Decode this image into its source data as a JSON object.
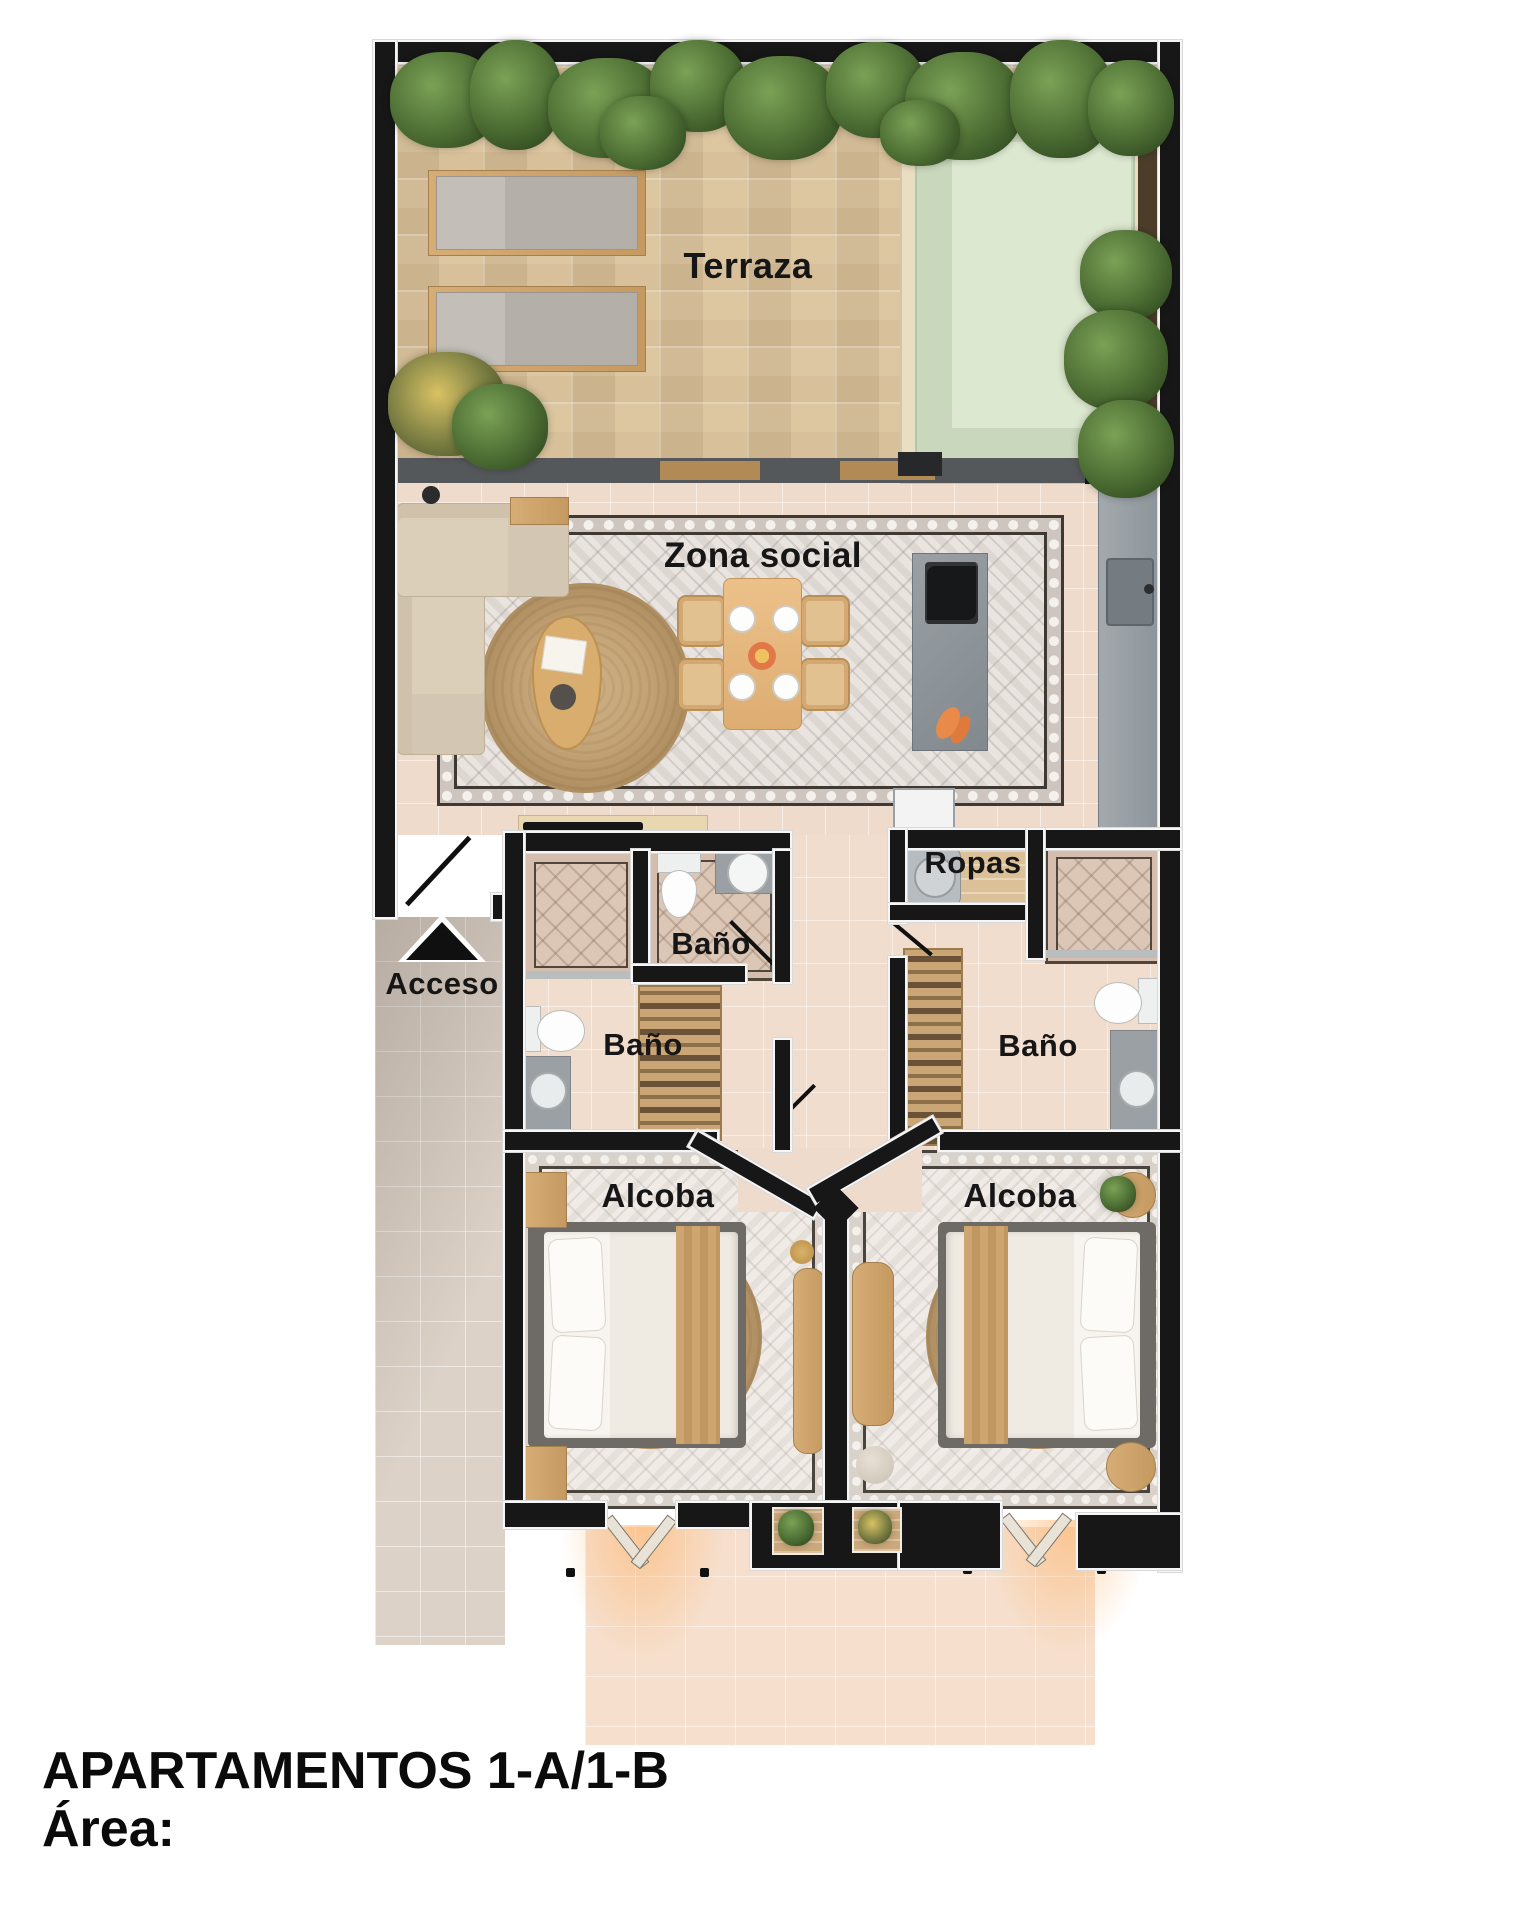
{
  "title": {
    "line1": "APARTAMENTOS 1-A/1-B",
    "line2": "Área:"
  },
  "rooms": {
    "terraza": "Terraza",
    "zona_social": "Zona social",
    "acceso": "Acceso",
    "bano_social": "Baño",
    "bano_1": "Baño",
    "bano_2": "Baño",
    "ropas": "Ropas",
    "alcoba_1": "Alcoba",
    "alcoba_2": "Alcoba"
  },
  "colors": {
    "wall": "#171717",
    "interior_floor": "#eedbcb",
    "exterior_corridor": "#dcd2c7",
    "entry_apron": "#f6dfcc",
    "terrace_stone": "#d8c3a0",
    "pool_water": "#c9d7bc",
    "pool_deck": "#e9ddc2",
    "rug_social": "#e9e4e0",
    "rug_bedroom": "#f0ebe7",
    "wood": "#d2a970",
    "plants": "#46662f",
    "counter_grey": "#99a0a5",
    "text": "#111111"
  }
}
